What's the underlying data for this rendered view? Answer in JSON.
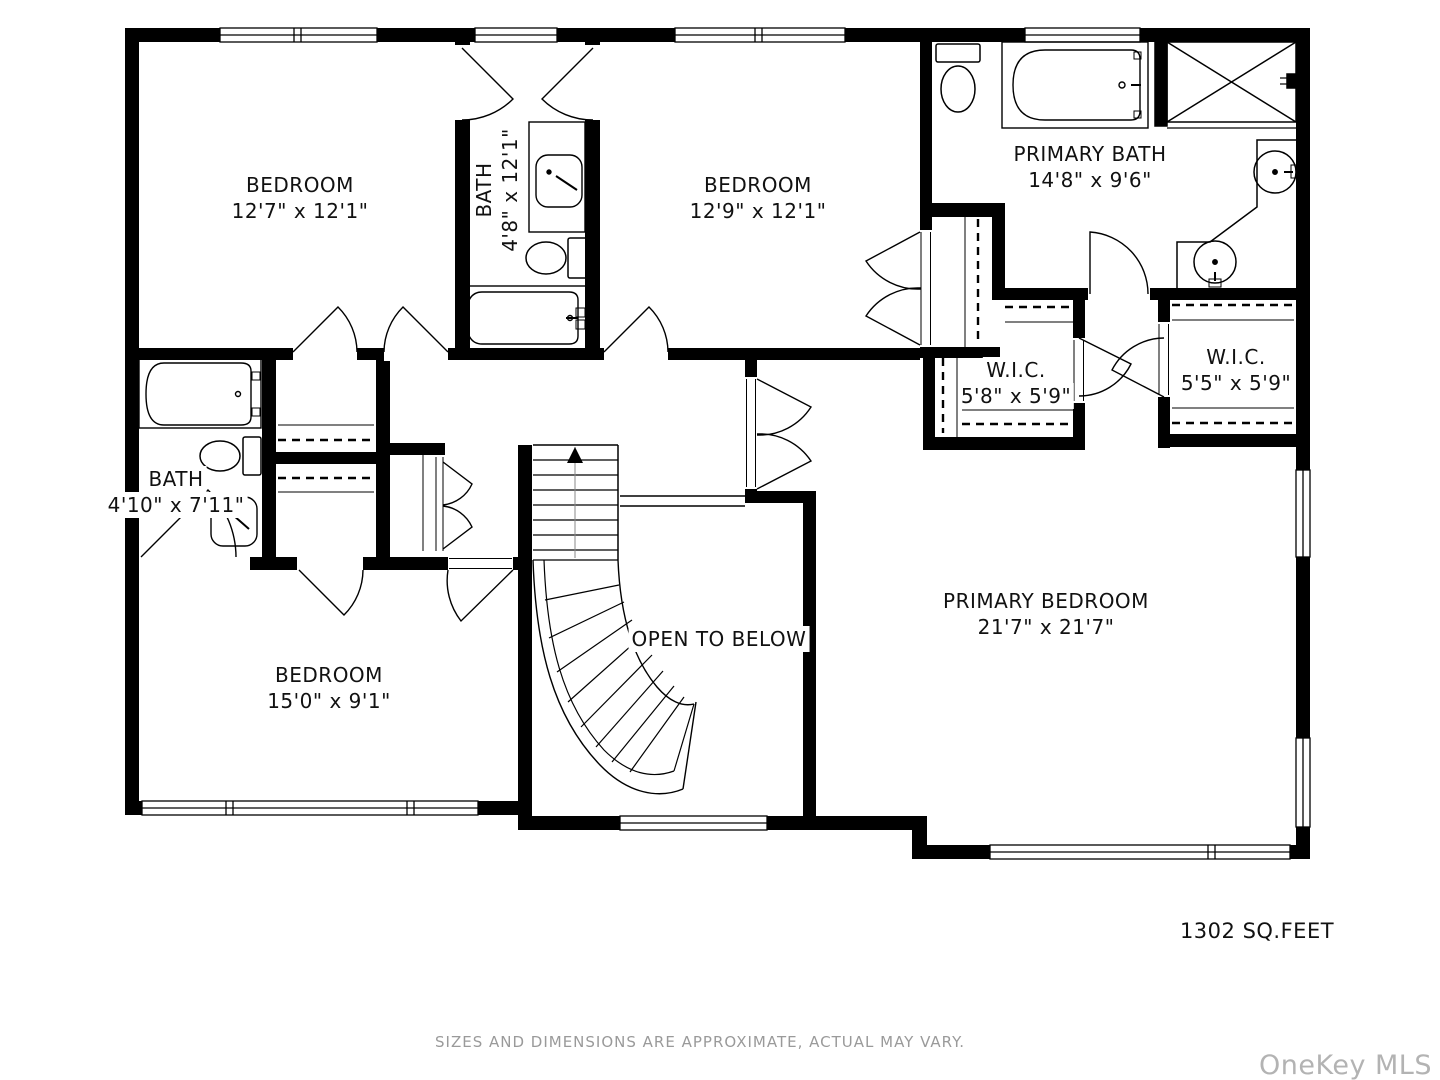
{
  "rooms": [
    {
      "id": "bedroom-1",
      "label": "BEDROOM",
      "dims": "12'7\" x 12'1\""
    },
    {
      "id": "bath-jack-and-jill",
      "label": "BATH",
      "dims": "4'8\" x 12'1\""
    },
    {
      "id": "bedroom-2",
      "label": "BEDROOM",
      "dims": "12'9\" x 12'1\""
    },
    {
      "id": "primary-bath",
      "label": "PRIMARY BATH",
      "dims": "14'8\" x 9'6\""
    },
    {
      "id": "wic-left",
      "label": "W.I.C.",
      "dims": "5'8\" x 5'9\""
    },
    {
      "id": "wic-right",
      "label": "W.I.C.",
      "dims": "5'5\" x 5'9\""
    },
    {
      "id": "bath-2",
      "label": "BATH",
      "dims": "4'10\" x 7'11\""
    },
    {
      "id": "bedroom-3",
      "label": "BEDROOM",
      "dims": "15'0\" x 9'1\""
    },
    {
      "id": "open-to-below",
      "label": "OPEN TO BELOW",
      "dims": ""
    },
    {
      "id": "primary-bedroom",
      "label": "PRIMARY BEDROOM",
      "dims": "21'7\" x 21'7\""
    }
  ],
  "annotations": {
    "area_label": "1302 SQ.FEET",
    "disclaimer": "SIZES AND DIMENSIONS ARE APPROXIMATE, ACTUAL MAY VARY.",
    "watermark": "OneKey MLS"
  },
  "colors": {
    "wall": "#000000",
    "label": "#111111",
    "muted": "#9a9a9a",
    "watermark": "#b3b3b3"
  }
}
